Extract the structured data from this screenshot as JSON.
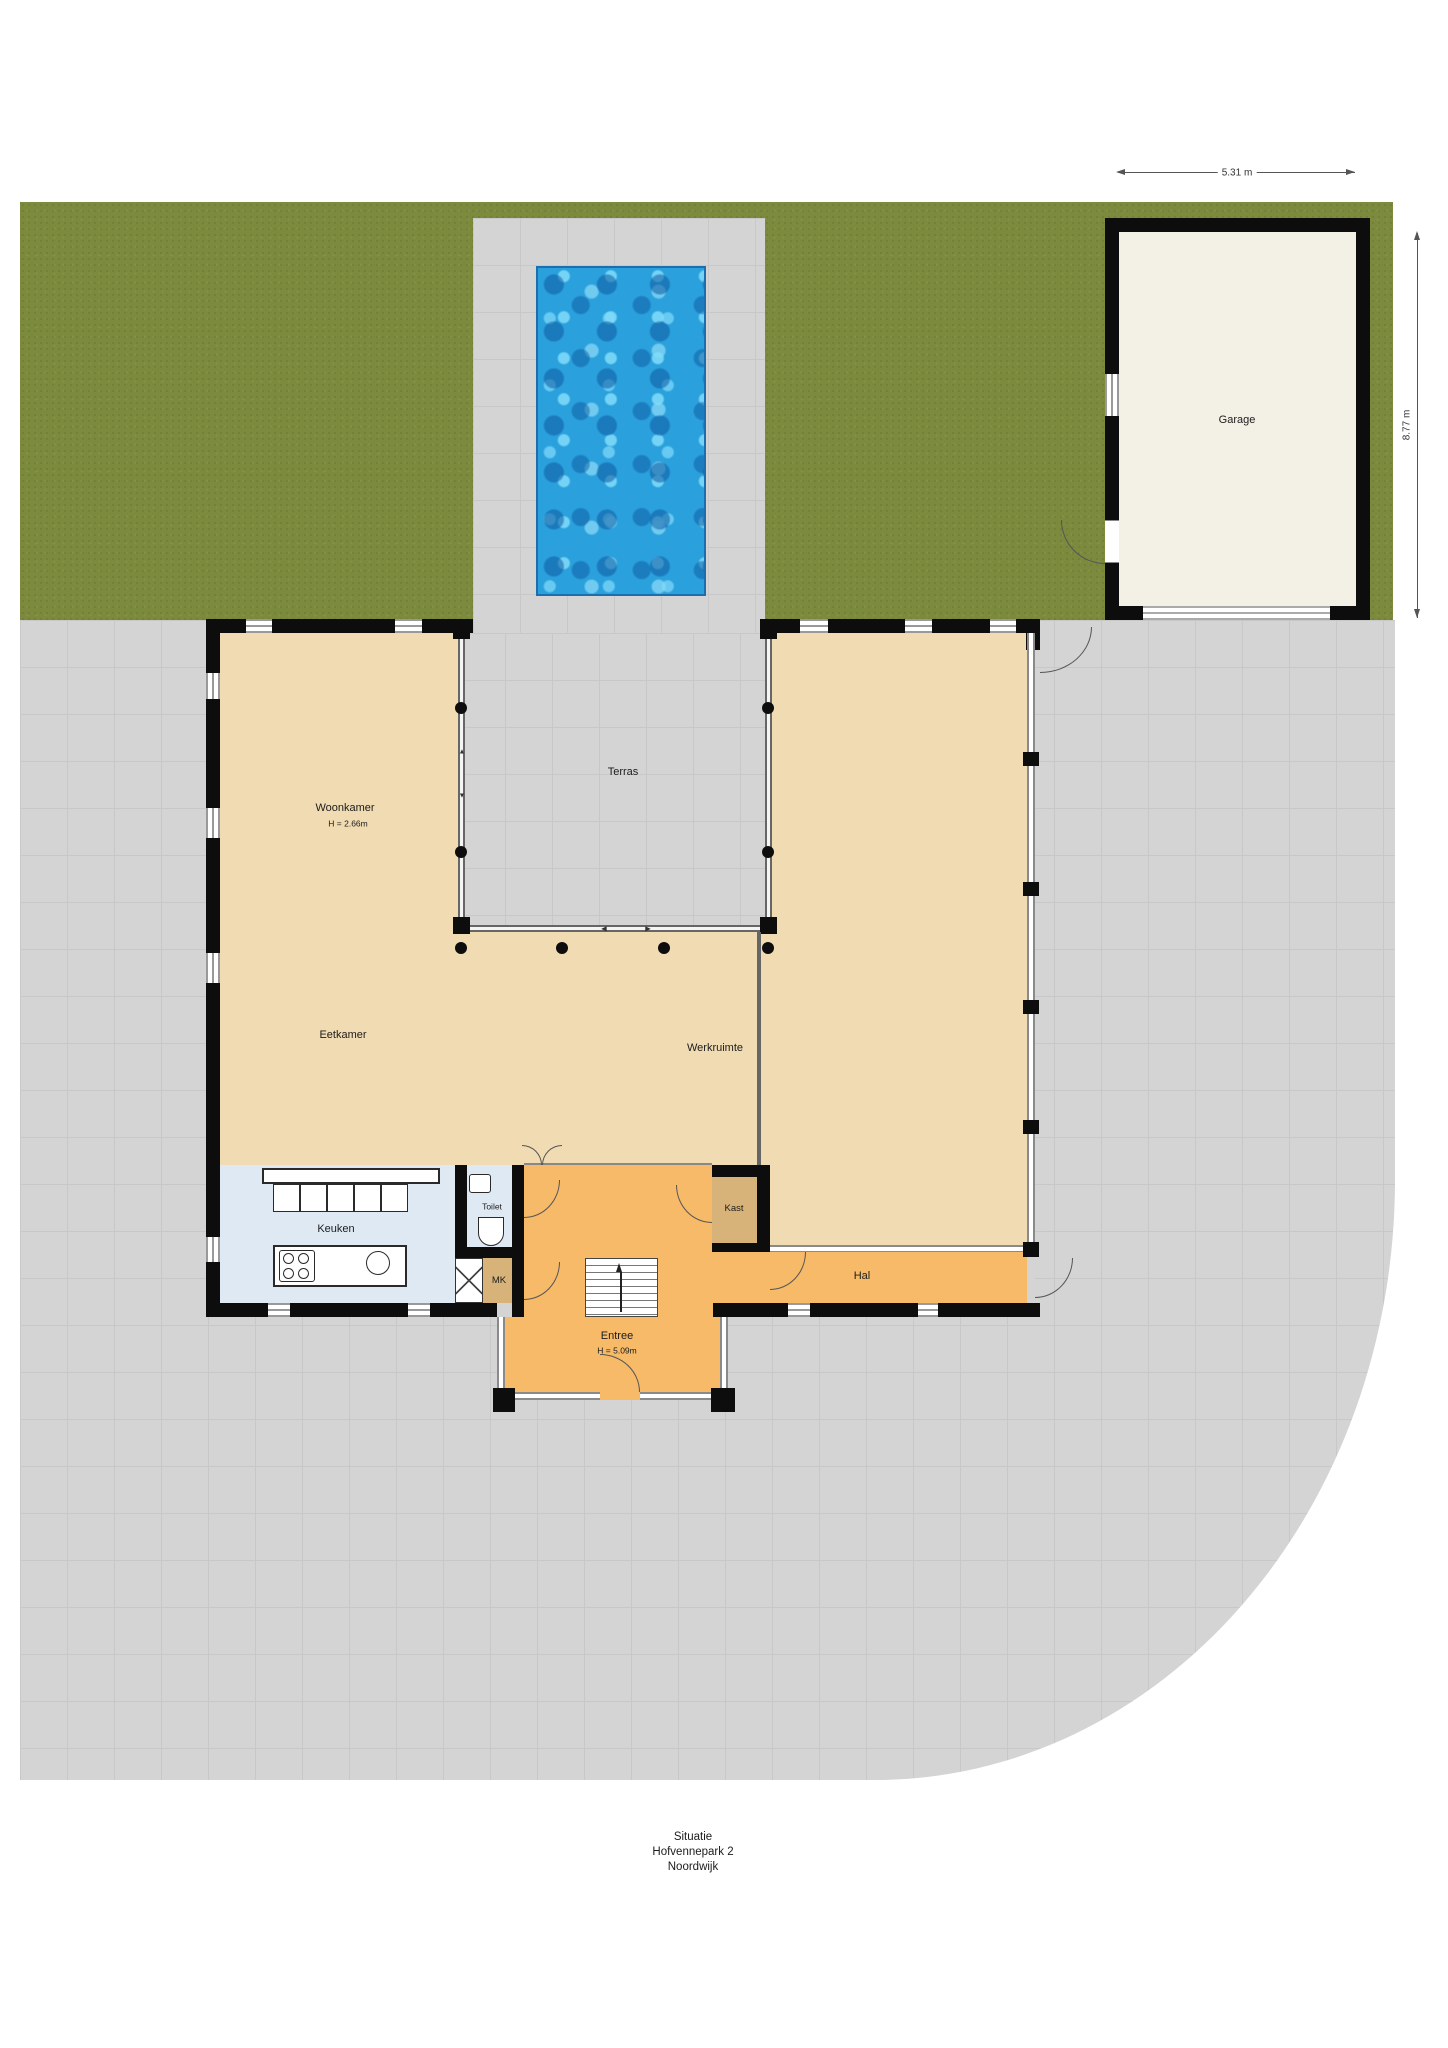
{
  "plan": {
    "type": "situatie-floorplan",
    "footer": {
      "line1": "Situatie",
      "line2": "Hofvennepark 2",
      "line3": "Noordwijk"
    }
  },
  "rooms": {
    "woonkamer": {
      "label": "Woonkamer",
      "height": "H = 2.66m"
    },
    "terras": {
      "label": "Terras"
    },
    "eetkamer": {
      "label": "Eetkamer"
    },
    "werkruimte": {
      "label": "Werkruimte"
    },
    "keuken": {
      "label": "Keuken"
    },
    "toilet": {
      "label": "Toilet"
    },
    "mk": {
      "label": "MK"
    },
    "kast": {
      "label": "Kast"
    },
    "hal": {
      "label": "Hal"
    },
    "entree": {
      "label": "Entree",
      "height": "H = 5.09m"
    },
    "garage": {
      "label": "Garage"
    }
  },
  "dimensions": {
    "garage_width": "5.31 m",
    "garage_height": "8.77 m"
  },
  "annotations": {
    "slide_left": "◄",
    "slide_right": "►",
    "arrow_up": "▲",
    "arrow_down": "▼"
  },
  "colors": {
    "grass": "#7c8a3d",
    "paving": "#d4d4d4",
    "paving_line": "#c8c8c8",
    "wall": "#0d0d0d",
    "cream": "#f1dbb2",
    "orange": "#f6ba68",
    "tan": "#d7b379",
    "blue": "#dfe9f4",
    "garage_floor": "#f3f0e5",
    "pool_base": "#2aa0dc",
    "pool_dark": "#1a74ba",
    "pool_light": "#85d7f3"
  }
}
